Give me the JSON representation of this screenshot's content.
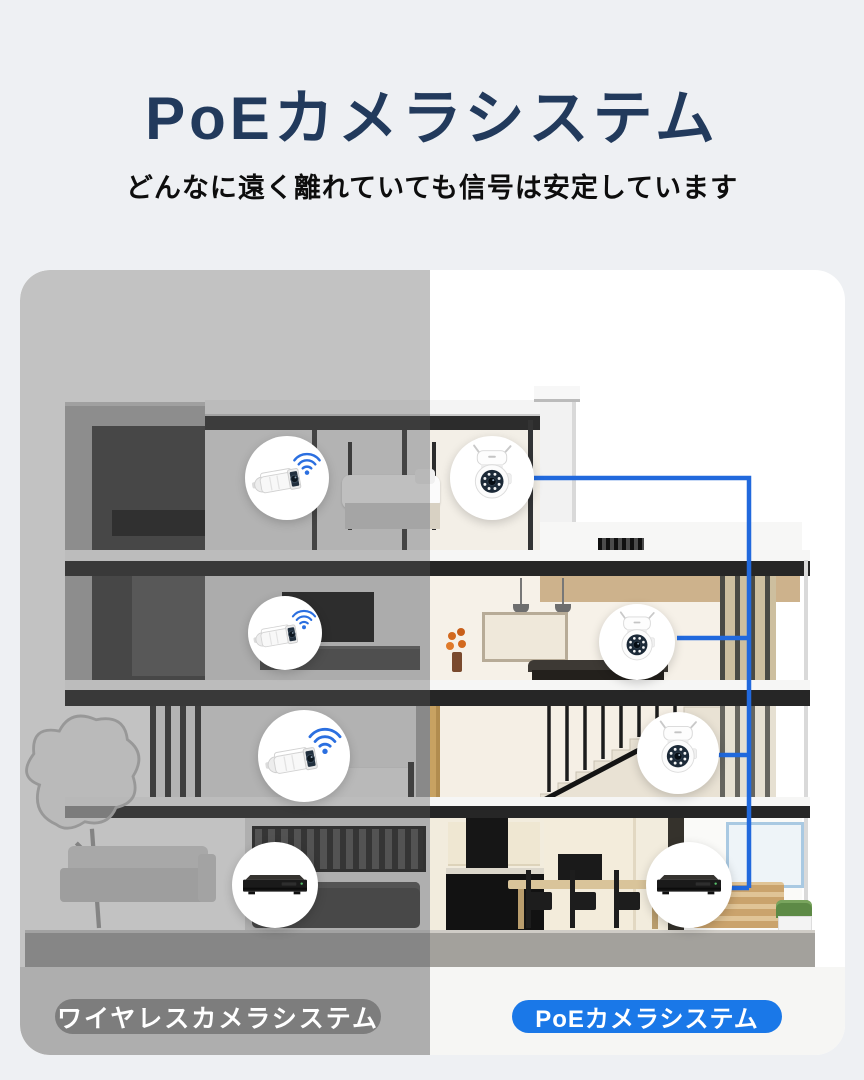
{
  "header": {
    "title": "PoEカメラシステム",
    "subtitle": "どんなに遠く離れていても信号は安定しています"
  },
  "labels": {
    "wireless": "ワイヤレスカメラシステム",
    "poe": "PoEカメラシステム"
  },
  "systems": {
    "wireless": {
      "side": "left",
      "cameras": 3,
      "recorder": "NVR",
      "connection": "wifi"
    },
    "poe": {
      "side": "right",
      "cameras": 3,
      "recorder": "NVR",
      "connection": "poe-cable"
    }
  },
  "colors": {
    "title_navy": "#223a5c",
    "cable_blue": "#2169dd",
    "wifi_blue": "#2b6fe0",
    "wireless_pill_gray": "#7d7d7d",
    "poe_pill_blue": "#1a78e8",
    "page_background": "#eef0f3"
  }
}
